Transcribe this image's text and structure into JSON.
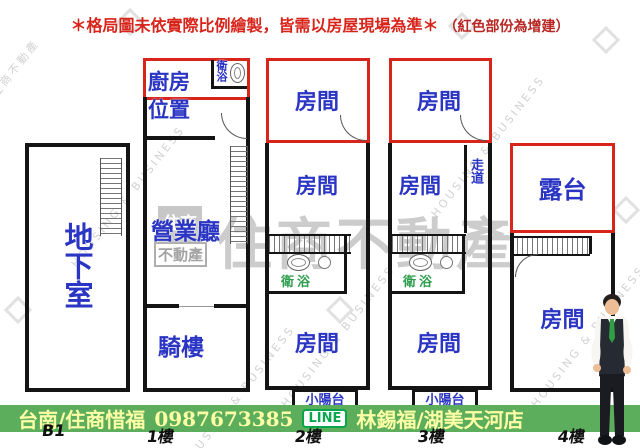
{
  "notice": {
    "main": "＊格局圖未依實際比例繪製，皆需以房屋現場為準＊",
    "sub": "（紅色部份為增建）"
  },
  "plan": {
    "basement": "地下室",
    "kitchen_line1": "廚房",
    "kitchen_line2": "位置",
    "bathroom": "衛浴",
    "business_hall": "營業廳",
    "arcade": "騎樓",
    "room": "房間",
    "corridor": "走道",
    "terrace": "露台",
    "small_balcony": "小陽台"
  },
  "floor_tags": [
    "B1",
    "1樓",
    "2樓",
    "3樓",
    "4樓"
  ],
  "watermark": {
    "brand": "住商不動產",
    "logo_text": "住商",
    "logo_sub": "不動產",
    "diagonal": "HOUSING & BUSINESS"
  },
  "footer": {
    "area_agent": "台南/住商惜福",
    "phone": "0987673385",
    "line": "LINE",
    "name_store": "林錫福/湖美天河店"
  },
  "colors": {
    "addition_red": "#d8251c",
    "wall_black": "#141414",
    "label_blue": "#2b35c3",
    "bath_green": "#2f9e4e",
    "bar_green": "#5cae5c",
    "bar_text_yellow": "#ffffa6"
  }
}
